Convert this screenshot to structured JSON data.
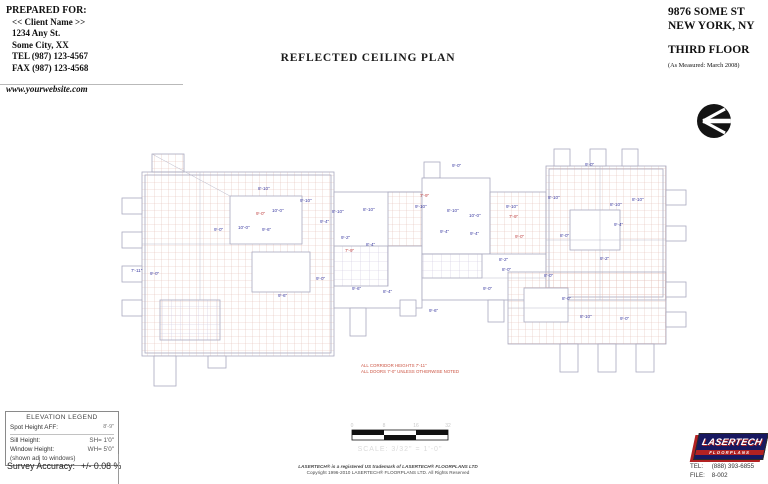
{
  "prepared_for": {
    "heading": "PREPARED FOR:",
    "lines": [
      "<< Client Name >>",
      "1234 Any St.",
      "Some City, XX",
      "TEL  (987) 123-4567",
      "FAX (987) 123-4568"
    ],
    "website": "www.yourwebsite.com"
  },
  "sheet_title": "REFLECTED CEILING PLAN",
  "site": {
    "address1": "9876 SOME ST",
    "address2": "NEW YORK, NY",
    "floor": "THIRD FLOOR",
    "measured": "(As Measured:  March 2008)"
  },
  "plan": {
    "notes": [
      "ALL CORRIDOR HEIGHTS 7'-11\"",
      "ALL DOORS 7'-0\" UNLESS OTHERWISE NOTED"
    ],
    "colors": {
      "grid": "#e2beb6",
      "grid_alt": "#cdc6dd",
      "outline": "#a9a9bf",
      "label_blue": "#3d3da2",
      "label_red": "#c04545",
      "note_red": "#cc5544"
    },
    "labels": [
      {
        "x": 131,
        "y": 272,
        "t": "7'-11\"",
        "c": "b"
      },
      {
        "x": 150,
        "y": 275,
        "t": "9'-0\"",
        "c": "b"
      },
      {
        "x": 214,
        "y": 231,
        "t": "9'-0\"",
        "c": "b"
      },
      {
        "x": 238,
        "y": 229,
        "t": "10'-0\"",
        "c": "b"
      },
      {
        "x": 262,
        "y": 231,
        "t": "9'-6\"",
        "c": "b"
      },
      {
        "x": 258,
        "y": 190,
        "t": "8'-10\"",
        "c": "b"
      },
      {
        "x": 272,
        "y": 212,
        "t": "10'-0\"",
        "c": "b"
      },
      {
        "x": 256,
        "y": 215,
        "t": "9'-0\"",
        "c": "r"
      },
      {
        "x": 278,
        "y": 297,
        "t": "9'-6\"",
        "c": "b"
      },
      {
        "x": 300,
        "y": 202,
        "t": "9'-10\"",
        "c": "b"
      },
      {
        "x": 320,
        "y": 223,
        "t": "9'-4\"",
        "c": "b"
      },
      {
        "x": 332,
        "y": 213,
        "t": "8'-10\"",
        "c": "b"
      },
      {
        "x": 341,
        "y": 239,
        "t": "9'-2\"",
        "c": "b"
      },
      {
        "x": 345,
        "y": 252,
        "t": "7'-9\"",
        "c": "r"
      },
      {
        "x": 363,
        "y": 211,
        "t": "8'-10\"",
        "c": "b"
      },
      {
        "x": 366,
        "y": 246,
        "t": "8'-4\"",
        "c": "b"
      },
      {
        "x": 352,
        "y": 290,
        "t": "9'-6\"",
        "c": "b"
      },
      {
        "x": 316,
        "y": 280,
        "t": "9'-0\"",
        "c": "b"
      },
      {
        "x": 383,
        "y": 293,
        "t": "8'-4\"",
        "c": "b"
      },
      {
        "x": 452,
        "y": 167,
        "t": "9'-0\"",
        "c": "b"
      },
      {
        "x": 420,
        "y": 197,
        "t": "7'-9\"",
        "c": "r"
      },
      {
        "x": 415,
        "y": 208,
        "t": "9'-10\"",
        "c": "b"
      },
      {
        "x": 447,
        "y": 212,
        "t": "8'-10\"",
        "c": "b"
      },
      {
        "x": 469,
        "y": 217,
        "t": "10'-0\"",
        "c": "b"
      },
      {
        "x": 440,
        "y": 233,
        "t": "9'-4\"",
        "c": "b"
      },
      {
        "x": 470,
        "y": 235,
        "t": "9'-4\"",
        "c": "b"
      },
      {
        "x": 506,
        "y": 208,
        "t": "9'-10\"",
        "c": "b"
      },
      {
        "x": 509,
        "y": 218,
        "t": "7'-9\"",
        "c": "r"
      },
      {
        "x": 515,
        "y": 238,
        "t": "9'-0\"",
        "c": "r"
      },
      {
        "x": 548,
        "y": 199,
        "t": "8'-10\"",
        "c": "b"
      },
      {
        "x": 560,
        "y": 237,
        "t": "8'-0\"",
        "c": "b"
      },
      {
        "x": 585,
        "y": 166,
        "t": "9'-0\"",
        "c": "b"
      },
      {
        "x": 610,
        "y": 206,
        "t": "8'-10\"",
        "c": "b"
      },
      {
        "x": 632,
        "y": 201,
        "t": "8'-10\"",
        "c": "b"
      },
      {
        "x": 614,
        "y": 226,
        "t": "9'-4\"",
        "c": "b"
      },
      {
        "x": 600,
        "y": 260,
        "t": "9'-2\"",
        "c": "b"
      },
      {
        "x": 544,
        "y": 277,
        "t": "8'-0\"",
        "c": "b"
      },
      {
        "x": 499,
        "y": 261,
        "t": "8'-2\"",
        "c": "b"
      },
      {
        "x": 483,
        "y": 290,
        "t": "9'-0\"",
        "c": "b"
      },
      {
        "x": 502,
        "y": 271,
        "t": "8'-0\"",
        "c": "b"
      },
      {
        "x": 429,
        "y": 312,
        "t": "9'-6\"",
        "c": "b"
      },
      {
        "x": 580,
        "y": 318,
        "t": "8'-10\"",
        "c": "b"
      },
      {
        "x": 620,
        "y": 320,
        "t": "9'-0\"",
        "c": "b"
      },
      {
        "x": 562,
        "y": 300,
        "t": "8'-0\"",
        "c": "b"
      }
    ]
  },
  "scale_bar": {
    "ticks": [
      "0",
      "8",
      "16",
      "32"
    ],
    "caption": "SCALE: 3/32\" = 1'-0\""
  },
  "legend": {
    "title": "ELEVATION LEGEND",
    "spot_label": "Spot Height AFF:",
    "spot_value": "8'-9\"",
    "sill_label": "Sill Height:",
    "sill_value": "SH= 1'0\"",
    "window_label": "Window Height:",
    "window_value": "WH= 5'0\"",
    "window_note": "(shown adj to windows)"
  },
  "survey": {
    "label": "Survey Accuracy:",
    "value": "+/-   0.08 %"
  },
  "copyright": [
    "LASERTECH® is a registered US trademark of LASERTECH® FLOORPLANS LTD",
    "Copyright 1996-2010 LASERTECH® FLOORPLANS LTD.  All Rights Reserved"
  ],
  "publisher": {
    "logo_line1": "LASERTECH",
    "logo_line2": "FLOORPLANS",
    "tel_label": "TEL:",
    "tel_value": "(888) 393-6855",
    "file_label": "FILE:",
    "file_value": "8-002"
  }
}
